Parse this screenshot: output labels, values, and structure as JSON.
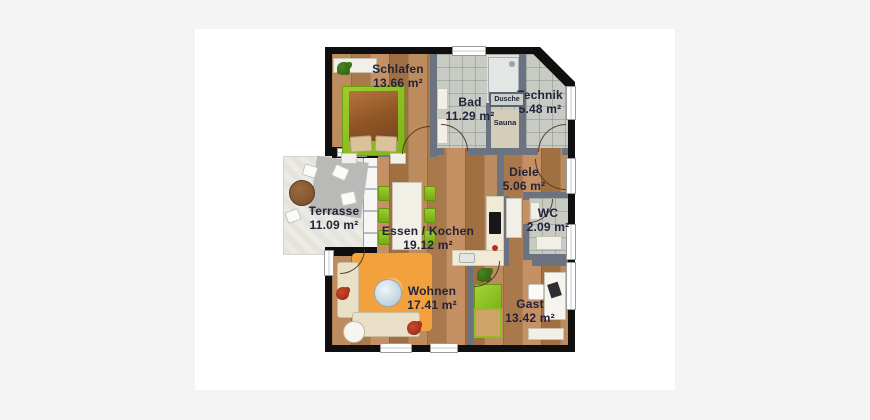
{
  "floorplan": {
    "rooms": [
      {
        "id": "schlafen",
        "label": "Schlafen",
        "area": "13.66 m²",
        "floor": "wood"
      },
      {
        "id": "bad",
        "label": "Bad",
        "area": "11.29 m²",
        "floor": "tile"
      },
      {
        "id": "technik",
        "label": "Technik",
        "area": "5.48 m²",
        "floor": "tile"
      },
      {
        "id": "diele",
        "label": "Diele",
        "area": "5.06 m²",
        "floor": "wood"
      },
      {
        "id": "wc",
        "label": "WC",
        "area": "2.09 m²",
        "floor": "tile"
      },
      {
        "id": "terrasse",
        "label": "Terrasse",
        "area": "11.09 m²",
        "floor": "stone"
      },
      {
        "id": "essen-kochen",
        "label": "Essen / Kochen",
        "area": "19.12 m²",
        "floor": "wood"
      },
      {
        "id": "wohnen",
        "label": "Wohnen",
        "area": "17.41 m²",
        "floor": "wood"
      },
      {
        "id": "gast",
        "label": "Gast",
        "area": "13.42 m²",
        "floor": "wood"
      }
    ],
    "annotations": {
      "dusche": "Dusche",
      "sauna": "Sauna"
    },
    "colors": {
      "page_background": "#f4f4f5",
      "card_background": "#ffffff",
      "exterior_wall": "#0f0f0f",
      "interior_wall": "#6b7380",
      "wood_floor": "#b2824f",
      "tile_floor": "#c8cbc4",
      "terrace_floor": "#eceae5",
      "accent_green": "#8fc31f",
      "accent_orange": "#f2a13c",
      "label_text": "#23233a"
    }
  }
}
